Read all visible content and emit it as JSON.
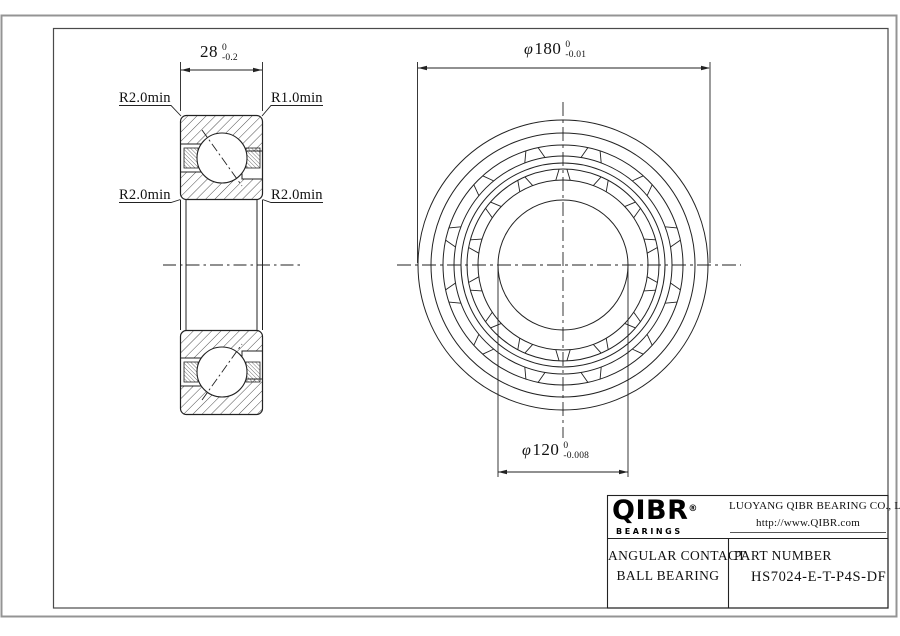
{
  "section_view": {
    "dim_width": {
      "value": "28",
      "tol_upper": "0",
      "tol_lower": "-0.2"
    },
    "labels": {
      "top_left": "R2.0min",
      "top_right": "R1.0min",
      "mid_left": "R2.0min",
      "mid_right": "R2.0min"
    }
  },
  "front_view": {
    "dim_od": {
      "symbol": "φ",
      "value": "180",
      "tol_upper": "0",
      "tol_lower": "-0.01"
    },
    "dim_bore": {
      "symbol": "φ",
      "value": "120",
      "tol_upper": "0",
      "tol_lower": "-0.008"
    }
  },
  "title_block": {
    "brand": "QIBR",
    "brand_reg": "®",
    "brand_sub": "BEARINGS",
    "company": "LUOYANG QIBR BEARING CO., LTD",
    "website": "http://www.QIBR.com",
    "product_line1": "ANGULAR CONTACT",
    "product_line2": "BALL BEARING",
    "part_number_label": "PART NUMBER",
    "part_number": "HS7024-E-T-P4S-DF"
  },
  "colors": {
    "line": "#222222",
    "frame_outer": "#949494",
    "background": "#ffffff",
    "brand": "#000000"
  }
}
